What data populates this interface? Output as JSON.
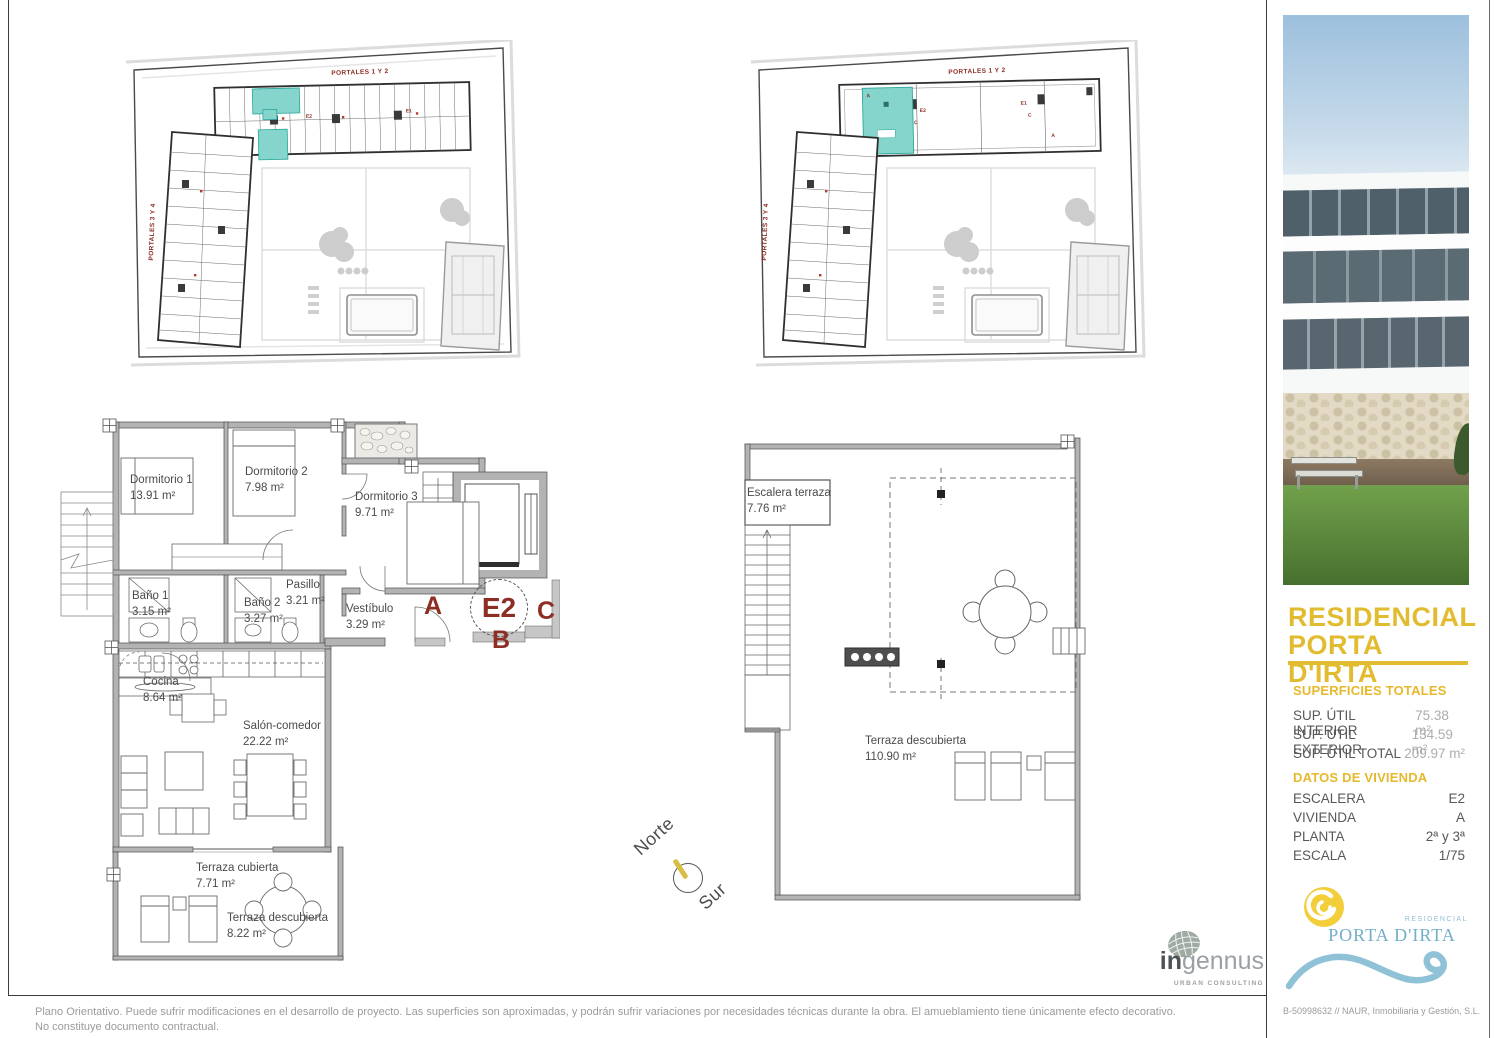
{
  "site_plan_1": {
    "label_top": "PORTALES 1 Y 2",
    "label_left": "PORTALES 3 Y 4",
    "marks": [
      "E2",
      "E1"
    ]
  },
  "site_plan_2": {
    "label_top": "PORTALES 1 Y 2",
    "label_left": "PORTALES 3 Y 4",
    "marks": [
      "A",
      "E2",
      "C",
      "E1",
      "C",
      "A"
    ]
  },
  "floor_plan": {
    "rooms": [
      {
        "name": "Dormitorio 1",
        "area": "13.91 m²"
      },
      {
        "name": "Dormitorio 2",
        "area": "7.98 m²"
      },
      {
        "name": "Dormitorio 3",
        "area": "9.71 m²"
      },
      {
        "name": "Baño 1",
        "area": "3.15 m²"
      },
      {
        "name": "Baño 2",
        "area": "3.27 m²"
      },
      {
        "name": "Pasillo",
        "area": "3.21 m²"
      },
      {
        "name": "Vestíbulo",
        "area": "3.29 m²"
      },
      {
        "name": "Cocina",
        "area": "8.64 m²"
      },
      {
        "name": "Salón-comedor",
        "area": "22.22 m²"
      },
      {
        "name": "Terraza cubierta",
        "area": "7.71 m²"
      },
      {
        "name": "Terraza descubierta",
        "area": "8.22 m²"
      }
    ],
    "markers": {
      "a": "A",
      "b": "B",
      "c": "C",
      "unit": "E2"
    }
  },
  "terrace_plan": {
    "rooms": [
      {
        "name": "Escalera terraza",
        "area": "7.76 m²"
      },
      {
        "name": "Terraza descubierta",
        "area": "110.90 m²"
      }
    ]
  },
  "compass": {
    "north": "Norte",
    "south": "Sur"
  },
  "sidebar": {
    "title_line1": "RESIDENCIAL",
    "title_line2": "PORTA D'IRTA",
    "surfaces": {
      "heading": "SUPERFICIES TOTALES",
      "rows": [
        {
          "label": "SUP. ÚTIL INTERIOR",
          "value": "75.38 m²"
        },
        {
          "label": "SUP. ÚTIL EXTERIOR",
          "value": "134.59 m²"
        },
        {
          "label": "SUP. ÚTIL TOTAL",
          "value": "209.97 m²"
        }
      ]
    },
    "dwelling": {
      "heading": "DATOS DE VIVIENDA",
      "rows": [
        {
          "label": "ESCALERA",
          "value": "E2"
        },
        {
          "label": "VIVIENDA",
          "value": "A"
        },
        {
          "label": "PLANTA",
          "value": "2ª y 3ª"
        },
        {
          "label": "ESCALA",
          "value": "1/75"
        }
      ]
    },
    "brand": {
      "small": "RESIDENCIAL",
      "name": "PORTA D'IRTA"
    },
    "footer": "B-50998632 // NAUR, Inmobiliaria y Gestión, S.L."
  },
  "ingennus": {
    "name_bold": "in",
    "name_light": "gennus",
    "tagline": "URBAN CONSULTING"
  },
  "disclaimer": "Plano Orientativo. Puede sufrir modificaciones en el desarrollo de proyecto. Las superficies son aproximadas, y podrán sufrir variaciones por necesidades técnicas durante la obra. El amueblamiento tiene únicamente efecto decorativo. No constituye documento contractual.",
  "colors": {
    "gold": "#E2BC30",
    "brick_red": "#8C2E24",
    "teal": "#85D5CD",
    "brand_blue": "#74B2CC",
    "sun_yellow": "#F2CE3A"
  }
}
